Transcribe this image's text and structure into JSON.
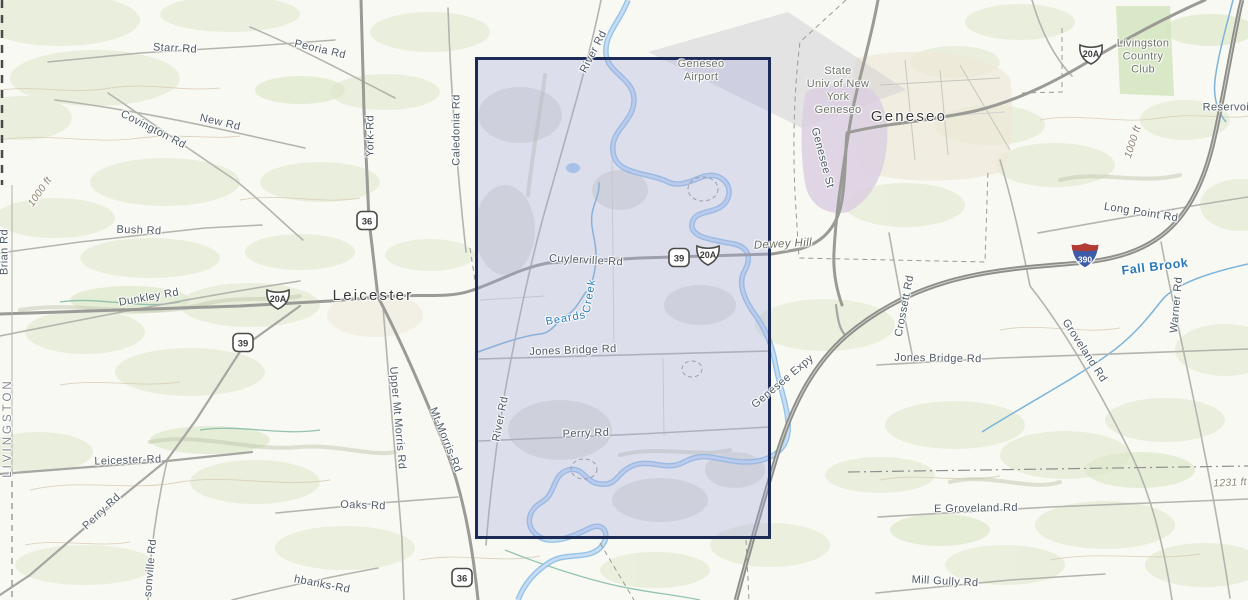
{
  "map": {
    "selection": {
      "x": 475,
      "y": 57,
      "width": 296,
      "height": 482
    },
    "colors": {
      "selection_border": "#1c2a56",
      "selection_fill": "rgba(165,170,220,0.34)",
      "water_label": "#2878b8",
      "road_label": "#4e5a64"
    },
    "labels": [
      {
        "name": "label-starr-rd",
        "text": "Starr Rd",
        "x": 175,
        "y": 49,
        "rot": 3,
        "cls": "road"
      },
      {
        "name": "label-peoria-rd",
        "text": "Peoria Rd",
        "x": 320,
        "y": 50,
        "rot": 13,
        "cls": "road"
      },
      {
        "name": "label-new-rd",
        "text": "New Rd",
        "x": 220,
        "y": 123,
        "rot": 13,
        "cls": "road"
      },
      {
        "name": "label-covington-rd",
        "text": "Covington Rd",
        "x": 153,
        "y": 130,
        "rot": 27,
        "cls": "road"
      },
      {
        "name": "label-york-rd",
        "text": "York-Rd",
        "x": 371,
        "y": 136,
        "rot": -90,
        "cls": "road"
      },
      {
        "name": "label-caledonia-rd",
        "text": "Caledonia Rd",
        "x": 457,
        "y": 130,
        "rot": -90,
        "cls": "road"
      },
      {
        "name": "label-river-rd-north",
        "text": "River Rd",
        "x": 594,
        "y": 52,
        "rot": -63,
        "cls": "road"
      },
      {
        "name": "label-geneseo-airport",
        "text": "Geneseo\nAirport",
        "x": 701,
        "y": 71,
        "rot": 0,
        "cls": "area"
      },
      {
        "name": "label-genesee-st",
        "text": "Genesee St",
        "x": 822,
        "y": 158,
        "rot": 75,
        "cls": "road"
      },
      {
        "name": "label-geneseo-place",
        "text": "Geneseo",
        "x": 909,
        "y": 117,
        "rot": 0,
        "cls": "place"
      },
      {
        "name": "label-suny-geneseo",
        "text": "State\nUniv of New\nYork\nGeneseo",
        "x": 838,
        "y": 91,
        "rot": 0,
        "cls": "area"
      },
      {
        "name": "label-livingston-country-club",
        "text": "Livingston\nCountry\nClub",
        "x": 1143,
        "y": 57,
        "rot": 0,
        "cls": "area"
      },
      {
        "name": "label-reservoir",
        "text": "Reservoir",
        "x": 1228,
        "y": 108,
        "rot": 0,
        "cls": "road"
      },
      {
        "name": "label-contour-1000-right",
        "text": "1000 ft",
        "x": 1133,
        "y": 142,
        "rot": -72,
        "cls": "terrain"
      },
      {
        "name": "label-contour-1000-left",
        "text": "1000 ft",
        "x": 40,
        "y": 192,
        "rot": -55,
        "cls": "terrain"
      },
      {
        "name": "label-long-point-rd",
        "text": "Long Point Rd",
        "x": 1141,
        "y": 213,
        "rot": 9,
        "cls": "road"
      },
      {
        "name": "label-fall-brook",
        "text": "Fall Brook",
        "x": 1155,
        "y": 267,
        "rot": -7,
        "cls": "water-lg"
      },
      {
        "name": "label-warner-rd",
        "text": "Warner Rd",
        "x": 1177,
        "y": 305,
        "rot": -85,
        "cls": "road"
      },
      {
        "name": "label-groveland-rd",
        "text": "Groveland Rd",
        "x": 1084,
        "y": 351,
        "rot": 57,
        "cls": "road"
      },
      {
        "name": "label-crossett-rd",
        "text": "Crossett Rd",
        "x": 905,
        "y": 306,
        "rot": -79,
        "cls": "road"
      },
      {
        "name": "label-jones-bridge-rd-east",
        "text": "Jones Bridge Rd",
        "x": 938,
        "y": 359,
        "rot": 1,
        "cls": "road"
      },
      {
        "name": "label-genesee-expy",
        "text": "Genesee Expy",
        "x": 783,
        "y": 382,
        "rot": -40,
        "cls": "road"
      },
      {
        "name": "label-dewey-hill",
        "text": "Dewey Hill",
        "x": 783,
        "y": 245,
        "rot": -3,
        "cls": "hill"
      },
      {
        "name": "label-cuylerville-rd",
        "text": "Cuylerville-Rd",
        "x": 586,
        "y": 261,
        "rot": 3,
        "cls": "road"
      },
      {
        "name": "label-beards",
        "text": "Beards",
        "x": 566,
        "y": 319,
        "rot": -10,
        "cls": "water"
      },
      {
        "name": "label-creek",
        "text": "Creek",
        "x": 590,
        "y": 296,
        "rot": -80,
        "cls": "water"
      },
      {
        "name": "label-jones-bridge-rd-west",
        "text": "Jones Bridge Rd",
        "x": 573,
        "y": 351,
        "rot": -2,
        "cls": "road"
      },
      {
        "name": "label-perry-rd-east",
        "text": "Perry Rd",
        "x": 586,
        "y": 434,
        "rot": -2,
        "cls": "road"
      },
      {
        "name": "label-river-rd-south",
        "text": "River Rd",
        "x": 501,
        "y": 419,
        "rot": -79,
        "cls": "road"
      },
      {
        "name": "label-leicester-place",
        "text": "Leicester",
        "x": 373,
        "y": 296,
        "rot": 0,
        "cls": "place"
      },
      {
        "name": "label-bush-rd",
        "text": "Bush Rd",
        "x": 139,
        "y": 231,
        "rot": 2,
        "cls": "road"
      },
      {
        "name": "label-dunkley-rd",
        "text": "Dunkley Rd",
        "x": 149,
        "y": 298,
        "rot": -10,
        "cls": "road"
      },
      {
        "name": "label-brian-rd",
        "text": "Brian Rd",
        "x": 5,
        "y": 252,
        "rot": -90,
        "cls": "road"
      },
      {
        "name": "label-livingston-county",
        "text": "LIVINGSTON",
        "x": 9,
        "y": 428,
        "rot": -90,
        "cls": "county"
      },
      {
        "name": "label-leicester-rd",
        "text": "Leicester-Rd",
        "x": 128,
        "y": 461,
        "rot": -2,
        "cls": "road"
      },
      {
        "name": "label-perry-rd-west",
        "text": "Perry-Rd",
        "x": 102,
        "y": 512,
        "rot": -43,
        "cls": "road"
      },
      {
        "name": "label-sonville-rd",
        "text": "sonville Rd",
        "x": 151,
        "y": 568,
        "rot": -85,
        "cls": "road"
      },
      {
        "name": "label-oaks-rd",
        "text": "Oaks Rd",
        "x": 363,
        "y": 506,
        "rot": 2,
        "cls": "road"
      },
      {
        "name": "label-upper-mt-morris-rd",
        "text": "Upper Mt Morris Rd",
        "x": 397,
        "y": 418,
        "rot": 85,
        "cls": "road"
      },
      {
        "name": "label-mt-morris-rd",
        "text": "Mt-Morris-Rd",
        "x": 445,
        "y": 440,
        "rot": 68,
        "cls": "road"
      },
      {
        "name": "label-hbanks-rd",
        "text": "hbanks-Rd",
        "x": 322,
        "y": 585,
        "rot": 11,
        "cls": "road"
      },
      {
        "name": "label-e-groveland-rd",
        "text": "E Groveland Rd",
        "x": 976,
        "y": 509,
        "rot": -1,
        "cls": "road"
      },
      {
        "name": "label-mill-gully-rd",
        "text": "Mill Gully Rd",
        "x": 945,
        "y": 582,
        "rot": 3,
        "cls": "road"
      },
      {
        "name": "label-contour-1231",
        "text": "1231 ft",
        "x": 1230,
        "y": 483,
        "rot": -3,
        "cls": "terrain"
      }
    ],
    "shields": [
      {
        "type": "ny",
        "label": "36",
        "x": 367,
        "y": 223
      },
      {
        "type": "us",
        "label": "20A",
        "x": 278,
        "y": 301
      },
      {
        "type": "ny",
        "label": "39",
        "x": 243,
        "y": 345
      },
      {
        "type": "ny",
        "label": "39",
        "x": 679,
        "y": 260
      },
      {
        "type": "us",
        "label": "20A",
        "x": 708,
        "y": 257
      },
      {
        "type": "us",
        "label": "20A",
        "x": 1091,
        "y": 56
      },
      {
        "type": "i",
        "label": "390",
        "x": 1085,
        "y": 258
      },
      {
        "type": "ny",
        "label": "36",
        "x": 462,
        "y": 580
      }
    ]
  }
}
